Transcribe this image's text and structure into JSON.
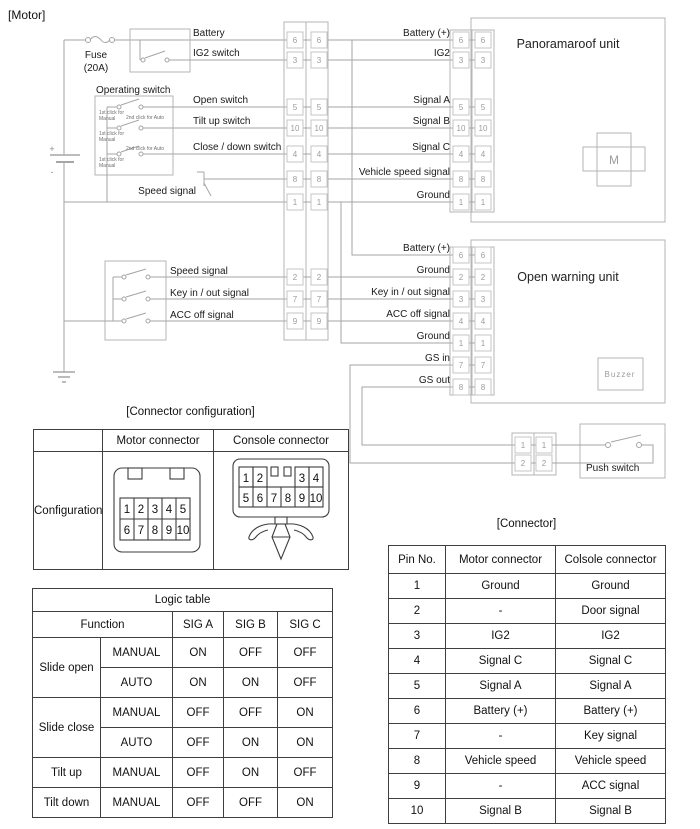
{
  "page_title": "[Motor]",
  "colors": {
    "wire": "#a6a6a6",
    "box": "#b6b6b6",
    "pin_text": "#9c9c9c",
    "label": "#1a1a1a",
    "table_border": "#3f3f3f"
  },
  "diagram": {
    "title": "[Motor]",
    "fuse_label_1": "Fuse",
    "fuse_label_2": "(20A)",
    "battery_plus": "+",
    "battery_minus": "-",
    "battery_line_label": "Battery",
    "ig2_switch_label": "IG2 switch",
    "operating_switch_title": "Operating switch",
    "click_note_1": "1st click for",
    "click_note_manual": "Manual",
    "click_note_2": "2nd click for Auto",
    "open_switch_label": "Open switch",
    "tilt_up_label": "Tilt up switch",
    "close_down_label": "Close / down switch",
    "speed_signal_label": "Speed signal",
    "trunk_pins": [
      "6",
      "3",
      "5",
      "10",
      "4",
      "8",
      "1",
      "2",
      "7",
      "9"
    ],
    "pano_unit": {
      "title": "Panoramaroof unit",
      "motor_letter": "M",
      "pins": [
        "6",
        "3",
        "5",
        "10",
        "4",
        "8",
        "1"
      ],
      "labels": [
        "Battery (+)",
        "IG2",
        "Signal A",
        "Signal B",
        "Signal C",
        "Vehicle speed signal",
        "Ground"
      ]
    },
    "warning_unit": {
      "title": "Open warning unit",
      "buzzer_label": "Buzzer",
      "pins": [
        "6",
        "2",
        "3",
        "4",
        "1",
        "7",
        "8"
      ],
      "labels": [
        "Battery (+)",
        "Ground",
        "Key in / out signal",
        "ACC off signal",
        "Ground",
        "GS in",
        "GS out"
      ]
    },
    "console_switch_labels": [
      "Speed signal",
      "Key in / out signal",
      "ACC off signal"
    ],
    "push_switch": {
      "title": "Push switch",
      "pins": [
        "1",
        "2"
      ]
    }
  },
  "config_table": {
    "title": "[Connector configuration]",
    "headers": [
      "",
      "Motor connector",
      "Console connector"
    ],
    "row_label": "Configuration",
    "motor_pins_row1": [
      "1",
      "2",
      "3",
      "4",
      "5"
    ],
    "motor_pins_row2": [
      "6",
      "7",
      "8",
      "9",
      "10"
    ],
    "console_pins_row1": [
      "1",
      "2",
      "3",
      "4"
    ],
    "console_pins_row2": [
      "5",
      "6",
      "7",
      "8",
      "9",
      "10"
    ]
  },
  "logic_table": {
    "title": "Logic table",
    "headers": [
      "Function",
      "SIG A",
      "SIG B",
      "SIG C"
    ],
    "rows": [
      {
        "group": "Slide open",
        "mode": "MANUAL",
        "a": "ON",
        "b": "OFF",
        "c": "OFF"
      },
      {
        "mode": "AUTO",
        "a": "ON",
        "b": "ON",
        "c": "OFF"
      },
      {
        "group": "Slide close",
        "mode": "MANUAL",
        "a": "OFF",
        "b": "OFF",
        "c": "ON"
      },
      {
        "mode": "AUTO",
        "a": "OFF",
        "b": "ON",
        "c": "ON"
      },
      {
        "group": "Tilt up",
        "mode": "MANUAL",
        "a": "OFF",
        "b": "ON",
        "c": "OFF"
      },
      {
        "group": "Tilt down",
        "mode": "MANUAL",
        "a": "OFF",
        "b": "OFF",
        "c": "ON"
      }
    ]
  },
  "connector_table": {
    "title": "[Connector]",
    "headers": [
      "Pin No.",
      "Motor connector",
      "Colsole connector"
    ],
    "rows": [
      {
        "pin": "1",
        "motor": "Ground",
        "console": "Ground"
      },
      {
        "pin": "2",
        "motor": "-",
        "console": "Door signal"
      },
      {
        "pin": "3",
        "motor": "IG2",
        "console": "IG2"
      },
      {
        "pin": "4",
        "motor": "Signal C",
        "console": "Signal C"
      },
      {
        "pin": "5",
        "motor": "Signal A",
        "console": "Signal A"
      },
      {
        "pin": "6",
        "motor": "Battery (+)",
        "console": "Battery (+)"
      },
      {
        "pin": "7",
        "motor": "-",
        "console": "Key signal"
      },
      {
        "pin": "8",
        "motor": "Vehicle speed",
        "console": "Vehicle speed"
      },
      {
        "pin": "9",
        "motor": "-",
        "console": "ACC signal"
      },
      {
        "pin": "10",
        "motor": "Signal B",
        "console": "Signal B"
      }
    ]
  }
}
